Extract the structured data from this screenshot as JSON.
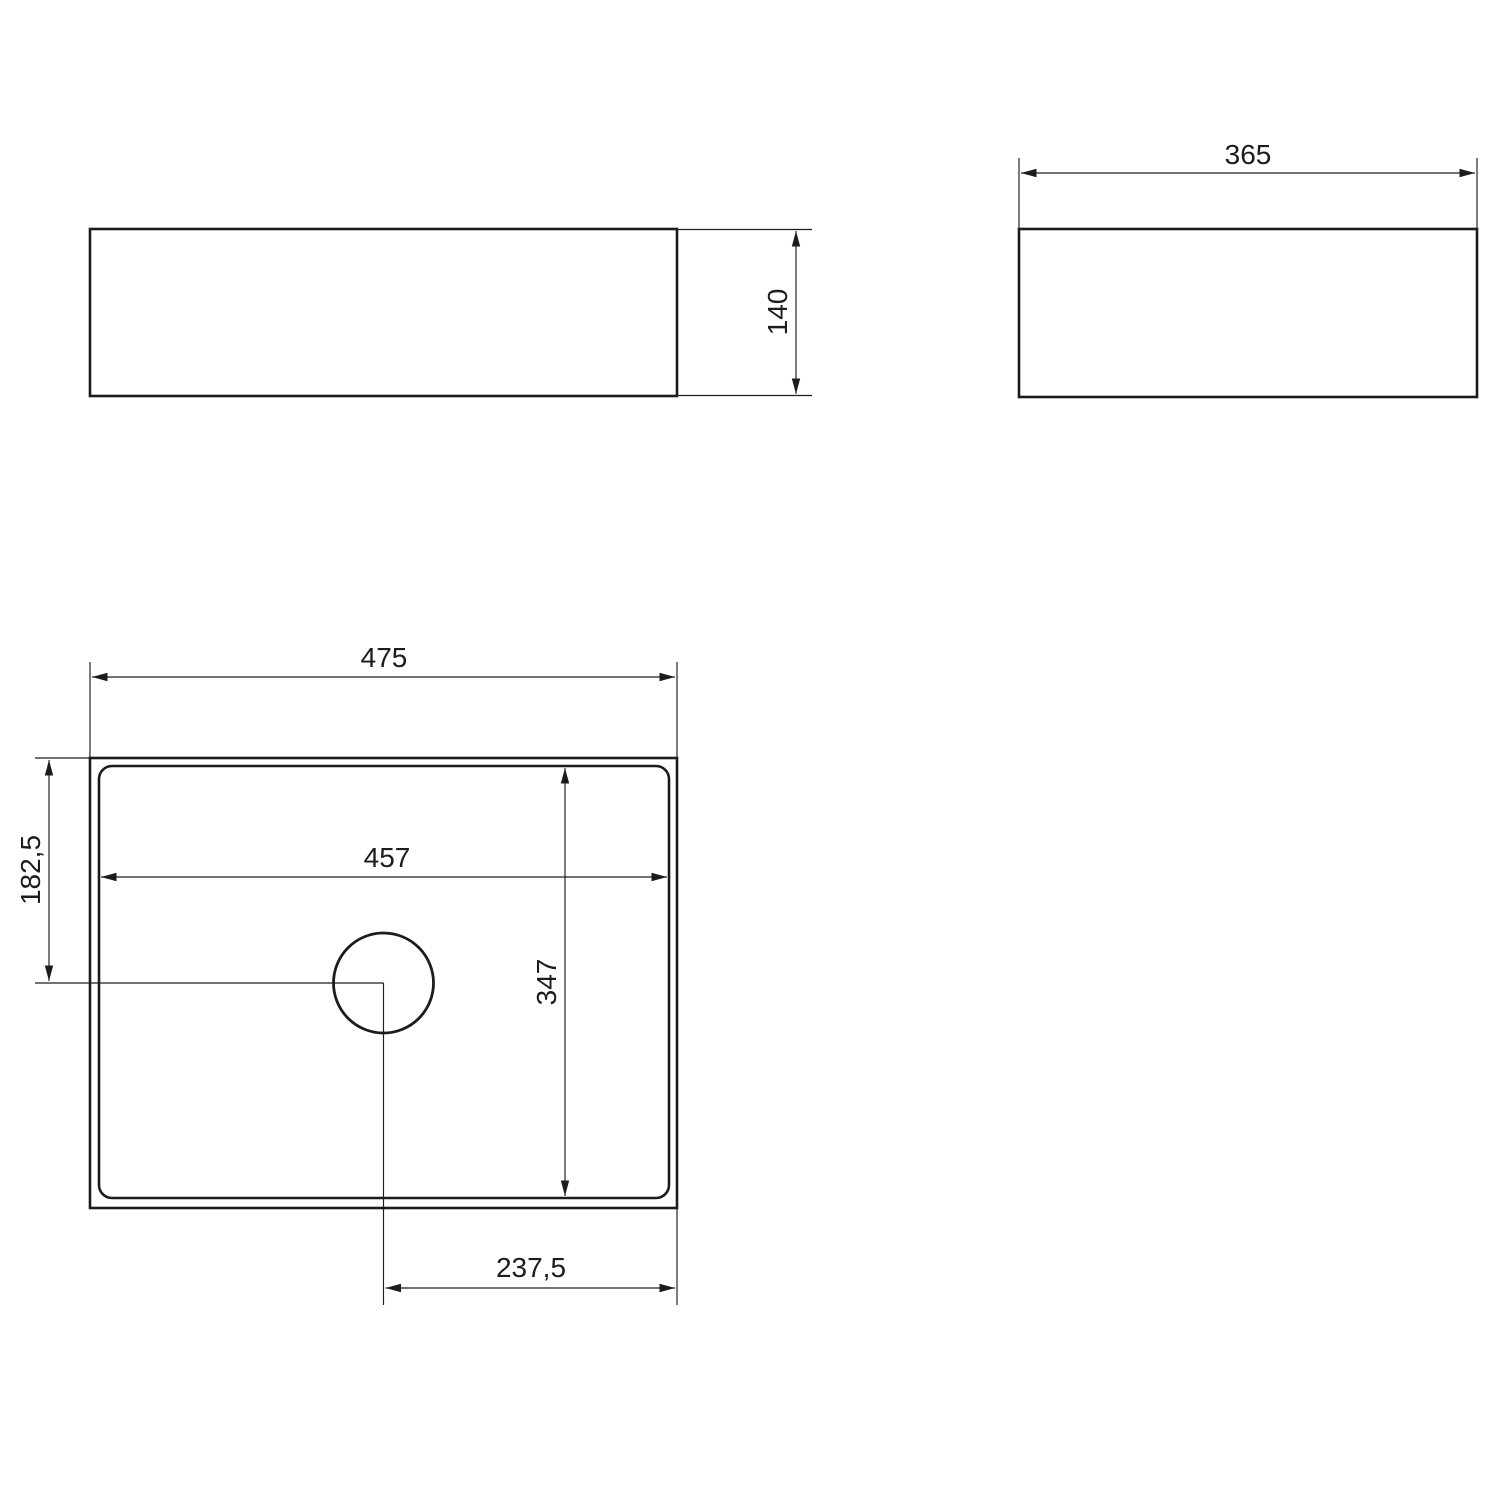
{
  "drawing": {
    "type": "technical-dimension-drawing",
    "colors": {
      "line": "#1c1c1c",
      "background": "#ffffff"
    },
    "dims": {
      "front_height": "140",
      "side_width": "365",
      "top_width": "475",
      "basin_inner_width": "457",
      "drain_center_from_top": "182,5",
      "basin_inner_depth": "347",
      "drain_center_from_right": "237,5"
    }
  }
}
